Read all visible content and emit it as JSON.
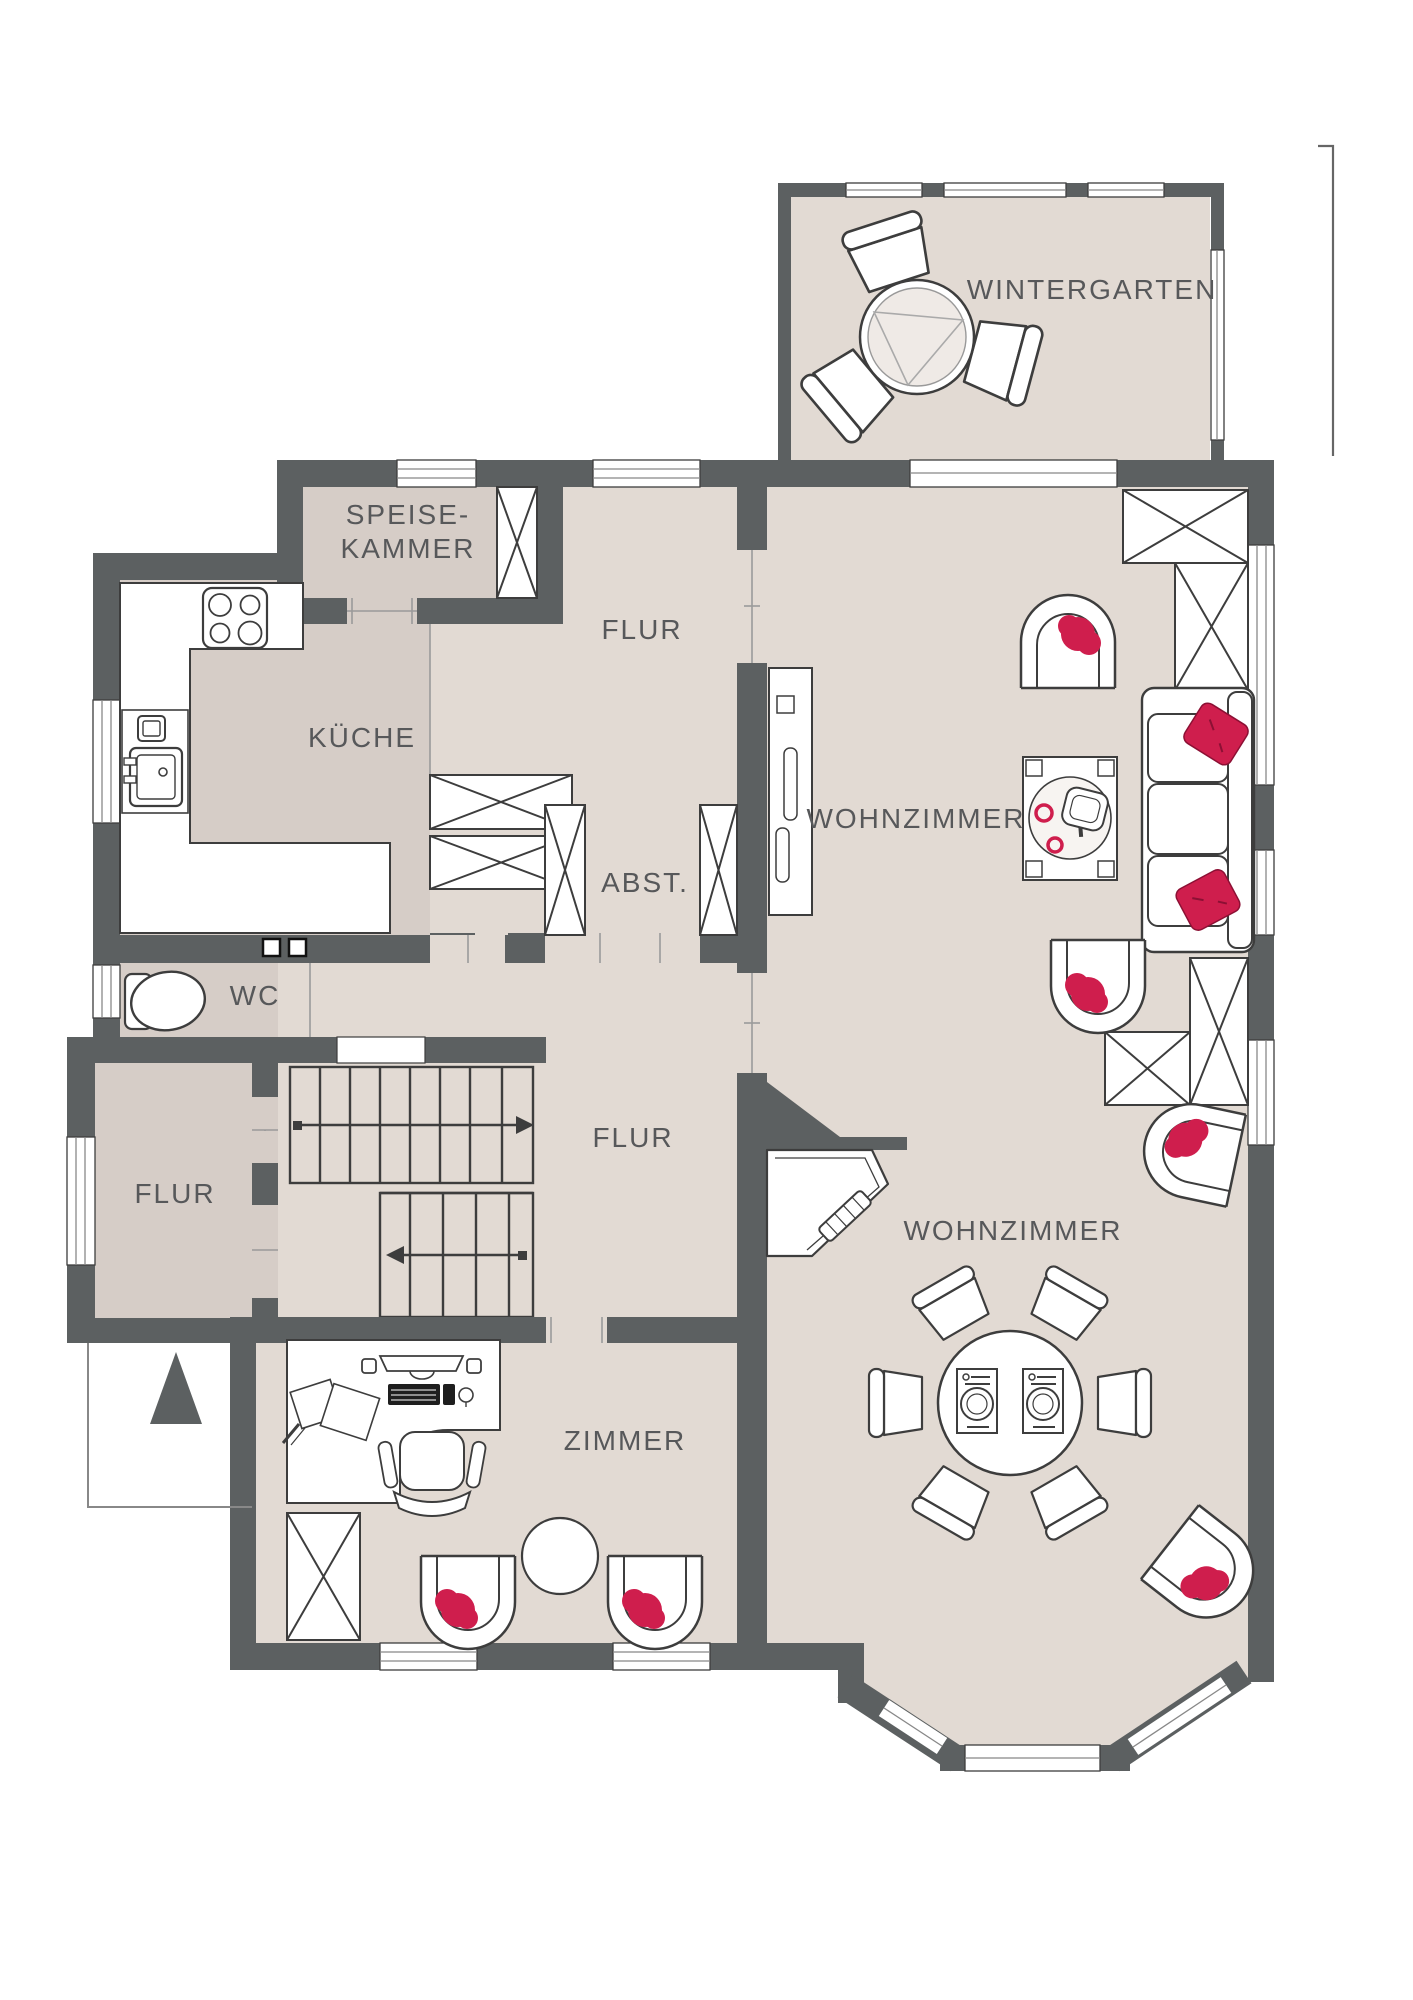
{
  "colors": {
    "wall": "#5c6061",
    "floor_light": "#e2dad3",
    "floor_dark": "#d6cdc7",
    "accent_red": "#cf1e4d",
    "furniture_outline": "#3d3d3d",
    "label_text": "#57585a",
    "furniture_fill": "#ffffff"
  },
  "rooms": {
    "wintergarten": {
      "label": "WINTERGARTEN"
    },
    "speisekammer": {
      "line1": "SPEISE-",
      "line2": "KAMMER"
    },
    "flur_top": {
      "label": "FLUR"
    },
    "kueche": {
      "label": "KÜCHE"
    },
    "wohnzimmer_upper": {
      "label": "WOHNZIMMER"
    },
    "abstellraum": {
      "label": "ABST."
    },
    "wc": {
      "label": "WC"
    },
    "flur_center": {
      "label": "FLUR"
    },
    "flur_left": {
      "label": "FLUR"
    },
    "wohnzimmer_lower": {
      "label": "WOHNZIMMER"
    },
    "zimmer": {
      "label": "ZIMMER"
    }
  }
}
